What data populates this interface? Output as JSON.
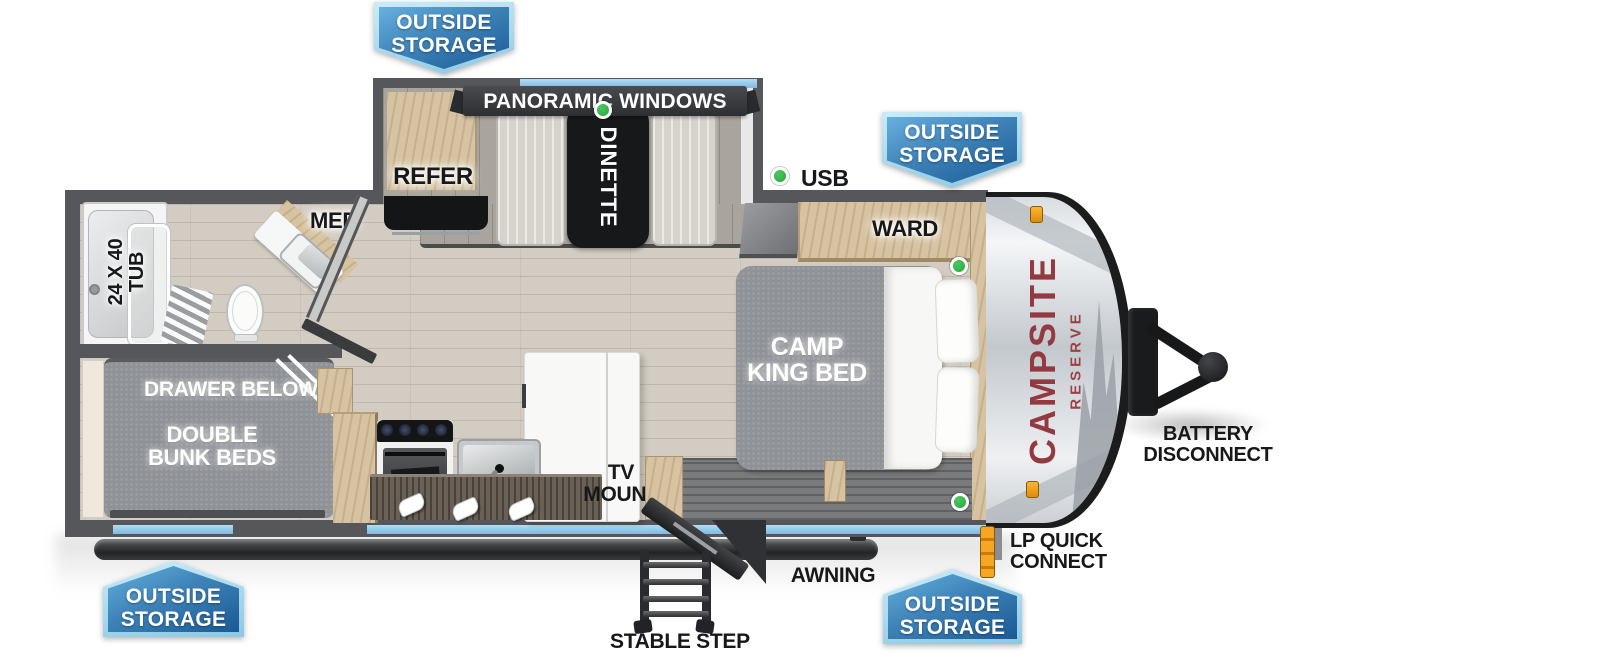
{
  "page": {
    "type": "travel trailer floorplan",
    "background": "#ffffff"
  },
  "colors": {
    "wall_gray": "#56575a",
    "window_blue": "#8fc6e8",
    "badge_light": "#8cc8e4",
    "badge_dark": "#1b5a95",
    "indicator_green": "#23a83c",
    "brand_red": "#933a41",
    "accent_orange": "#e8920a"
  },
  "brand": {
    "primary": "CAMPSITE",
    "secondary": "RESERVE"
  },
  "badges": {
    "line1": "OUTSIDE",
    "line2": "STORAGE"
  },
  "labels": {
    "panoramic_windows": "PANORAMIC WINDOWS",
    "refer": "REFER",
    "dinette": "DINETTE",
    "usb": "USB",
    "med": "MED",
    "tub_line1": "24 X 40",
    "tub_line2": "TUB",
    "ward": "WARD",
    "bed_line1": "CAMP",
    "bed_line2": "KING BED",
    "bunk_drawer": "DRAWER BELOW",
    "bunk_line1": "DOUBLE",
    "bunk_line2": "BUNK BEDS",
    "tv_line1": "TV",
    "tv_line2": "MOUNT",
    "awning": "AWNING",
    "stable_step": "STABLE STEP",
    "lp_line1": "LP QUICK",
    "lp_line2": "CONNECT",
    "battery_line1": "BATTERY",
    "battery_line2": "DISCONNECT"
  }
}
